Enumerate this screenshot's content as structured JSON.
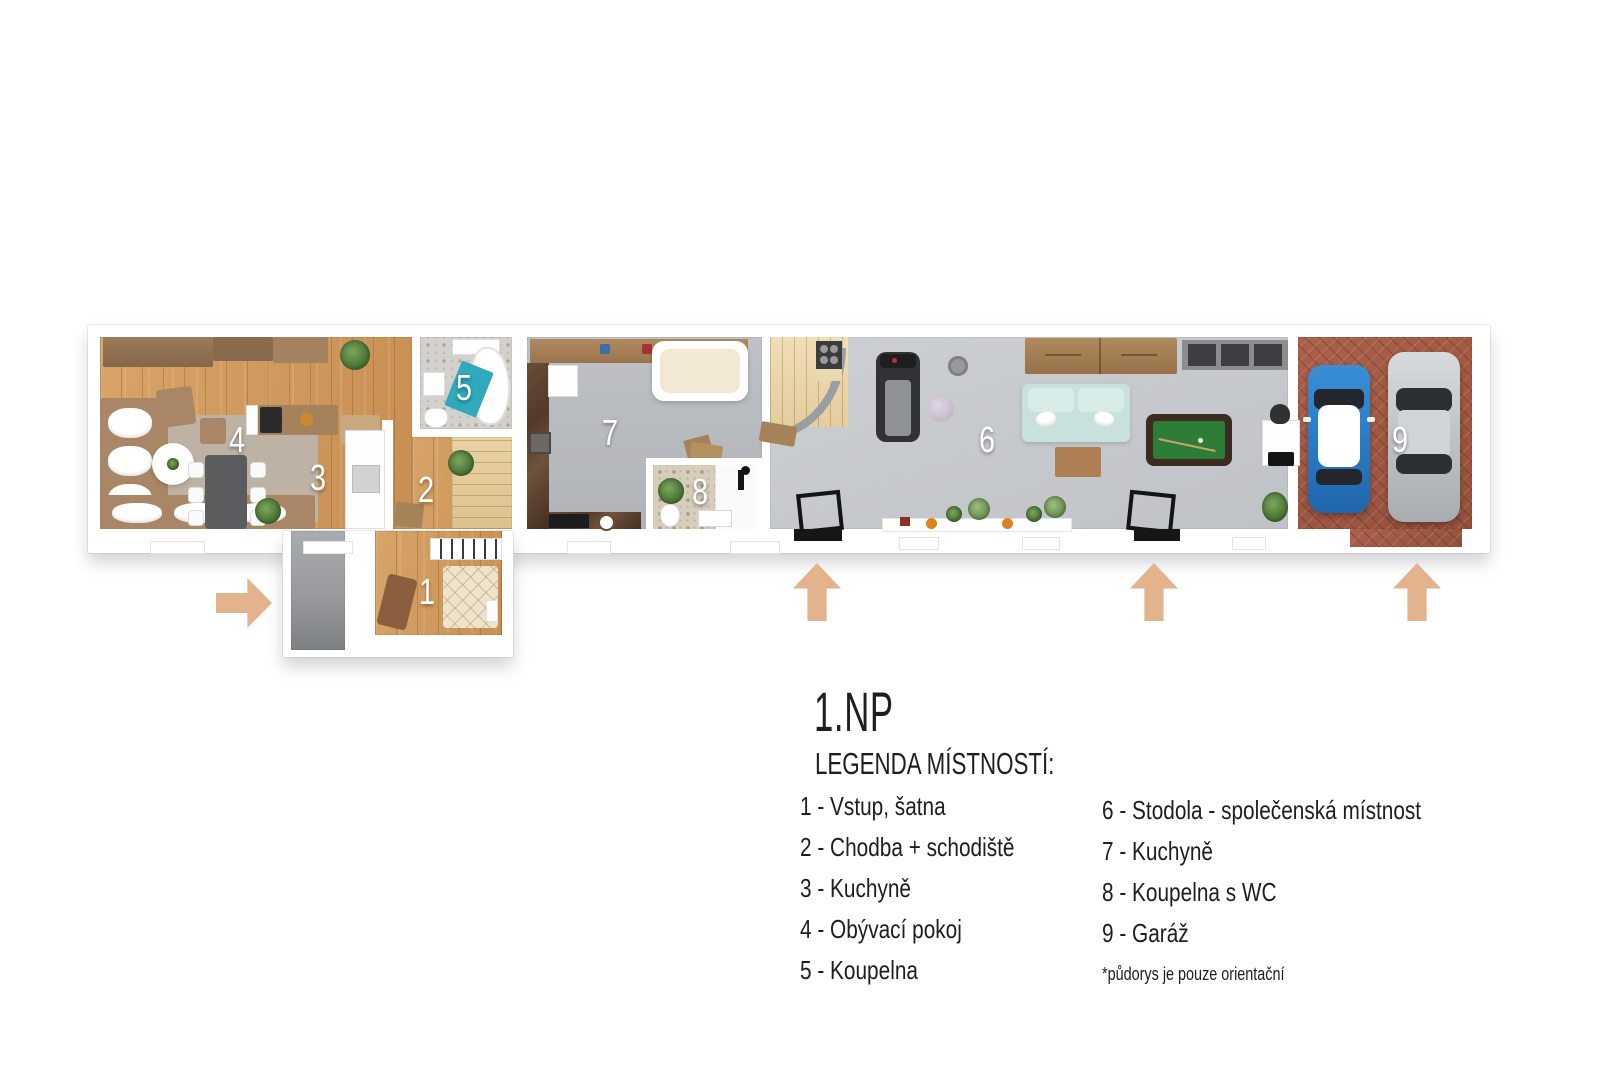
{
  "palette": {
    "background": "#ffffff",
    "woodFloor": "#d8a469",
    "woodFloorDark": "#c88f52",
    "stairWood": "#ead2a2",
    "grayFloorKitchen": "#b9bcc0",
    "grayFloorBarn": "#c8cbce",
    "vestibuleGray": "#96999c",
    "brickFloor": "#a55c45",
    "marbleTile": "#5d4330",
    "bathTile": "#d4d1cc",
    "bathTileBeige": "#d7cdbd",
    "tealAccent": "#2fa9bb",
    "tealSofa": "#c9e1dc",
    "poolFelt": "#2e7d37",
    "poolRail": "#3d2b21",
    "carBlue": "#2b7ec9",
    "carSilver": "#c7ccce",
    "arrowTan": "#e2b38c",
    "furnitureBrown": "#a98666",
    "furnitureWood": "#a6825a",
    "creamFabric": "#f3e9d2",
    "rugCream": "#eee3cd",
    "plantGreen": "#4d7c3c",
    "textDark": "#1e1e1e",
    "labelWhite": "#ffffff"
  },
  "plan": {
    "floor_title": "1.NP",
    "rooms": [
      {
        "number": "1",
        "name": "Vstup, šatna"
      },
      {
        "number": "2",
        "name": "Chodba + schodiště"
      },
      {
        "number": "3",
        "name": "Kuchyně"
      },
      {
        "number": "4",
        "name": "Obývací pokoj"
      },
      {
        "number": "5",
        "name": "Koupelna"
      },
      {
        "number": "6",
        "name": "Stodola - společenská místnost"
      },
      {
        "number": "7",
        "name": "Kuchyně"
      },
      {
        "number": "8",
        "name": "Koupelna s WC"
      },
      {
        "number": "9",
        "name": "Garáž"
      }
    ],
    "arrows": [
      {
        "id": "entrance-west",
        "direction": "right"
      },
      {
        "id": "entrance-center",
        "direction": "up"
      },
      {
        "id": "entrance-east",
        "direction": "up"
      },
      {
        "id": "garage-entrance",
        "direction": "up"
      }
    ]
  },
  "legend": {
    "title": "1.NP",
    "heading": "LEGENDA MÍSTNOSTÍ:",
    "left": [
      "1 - Vstup, šatna",
      "2 - Chodba + schodiště",
      "3 - Kuchyně",
      "4 - Obývací pokoj",
      "5 - Koupelna"
    ],
    "right": [
      "6 - Stodola - společenská místnost",
      "7 - Kuchyně",
      "8 - Koupelna s WC",
      "9 - Garáž"
    ],
    "footnote": "*půdorys je pouze orientační"
  }
}
